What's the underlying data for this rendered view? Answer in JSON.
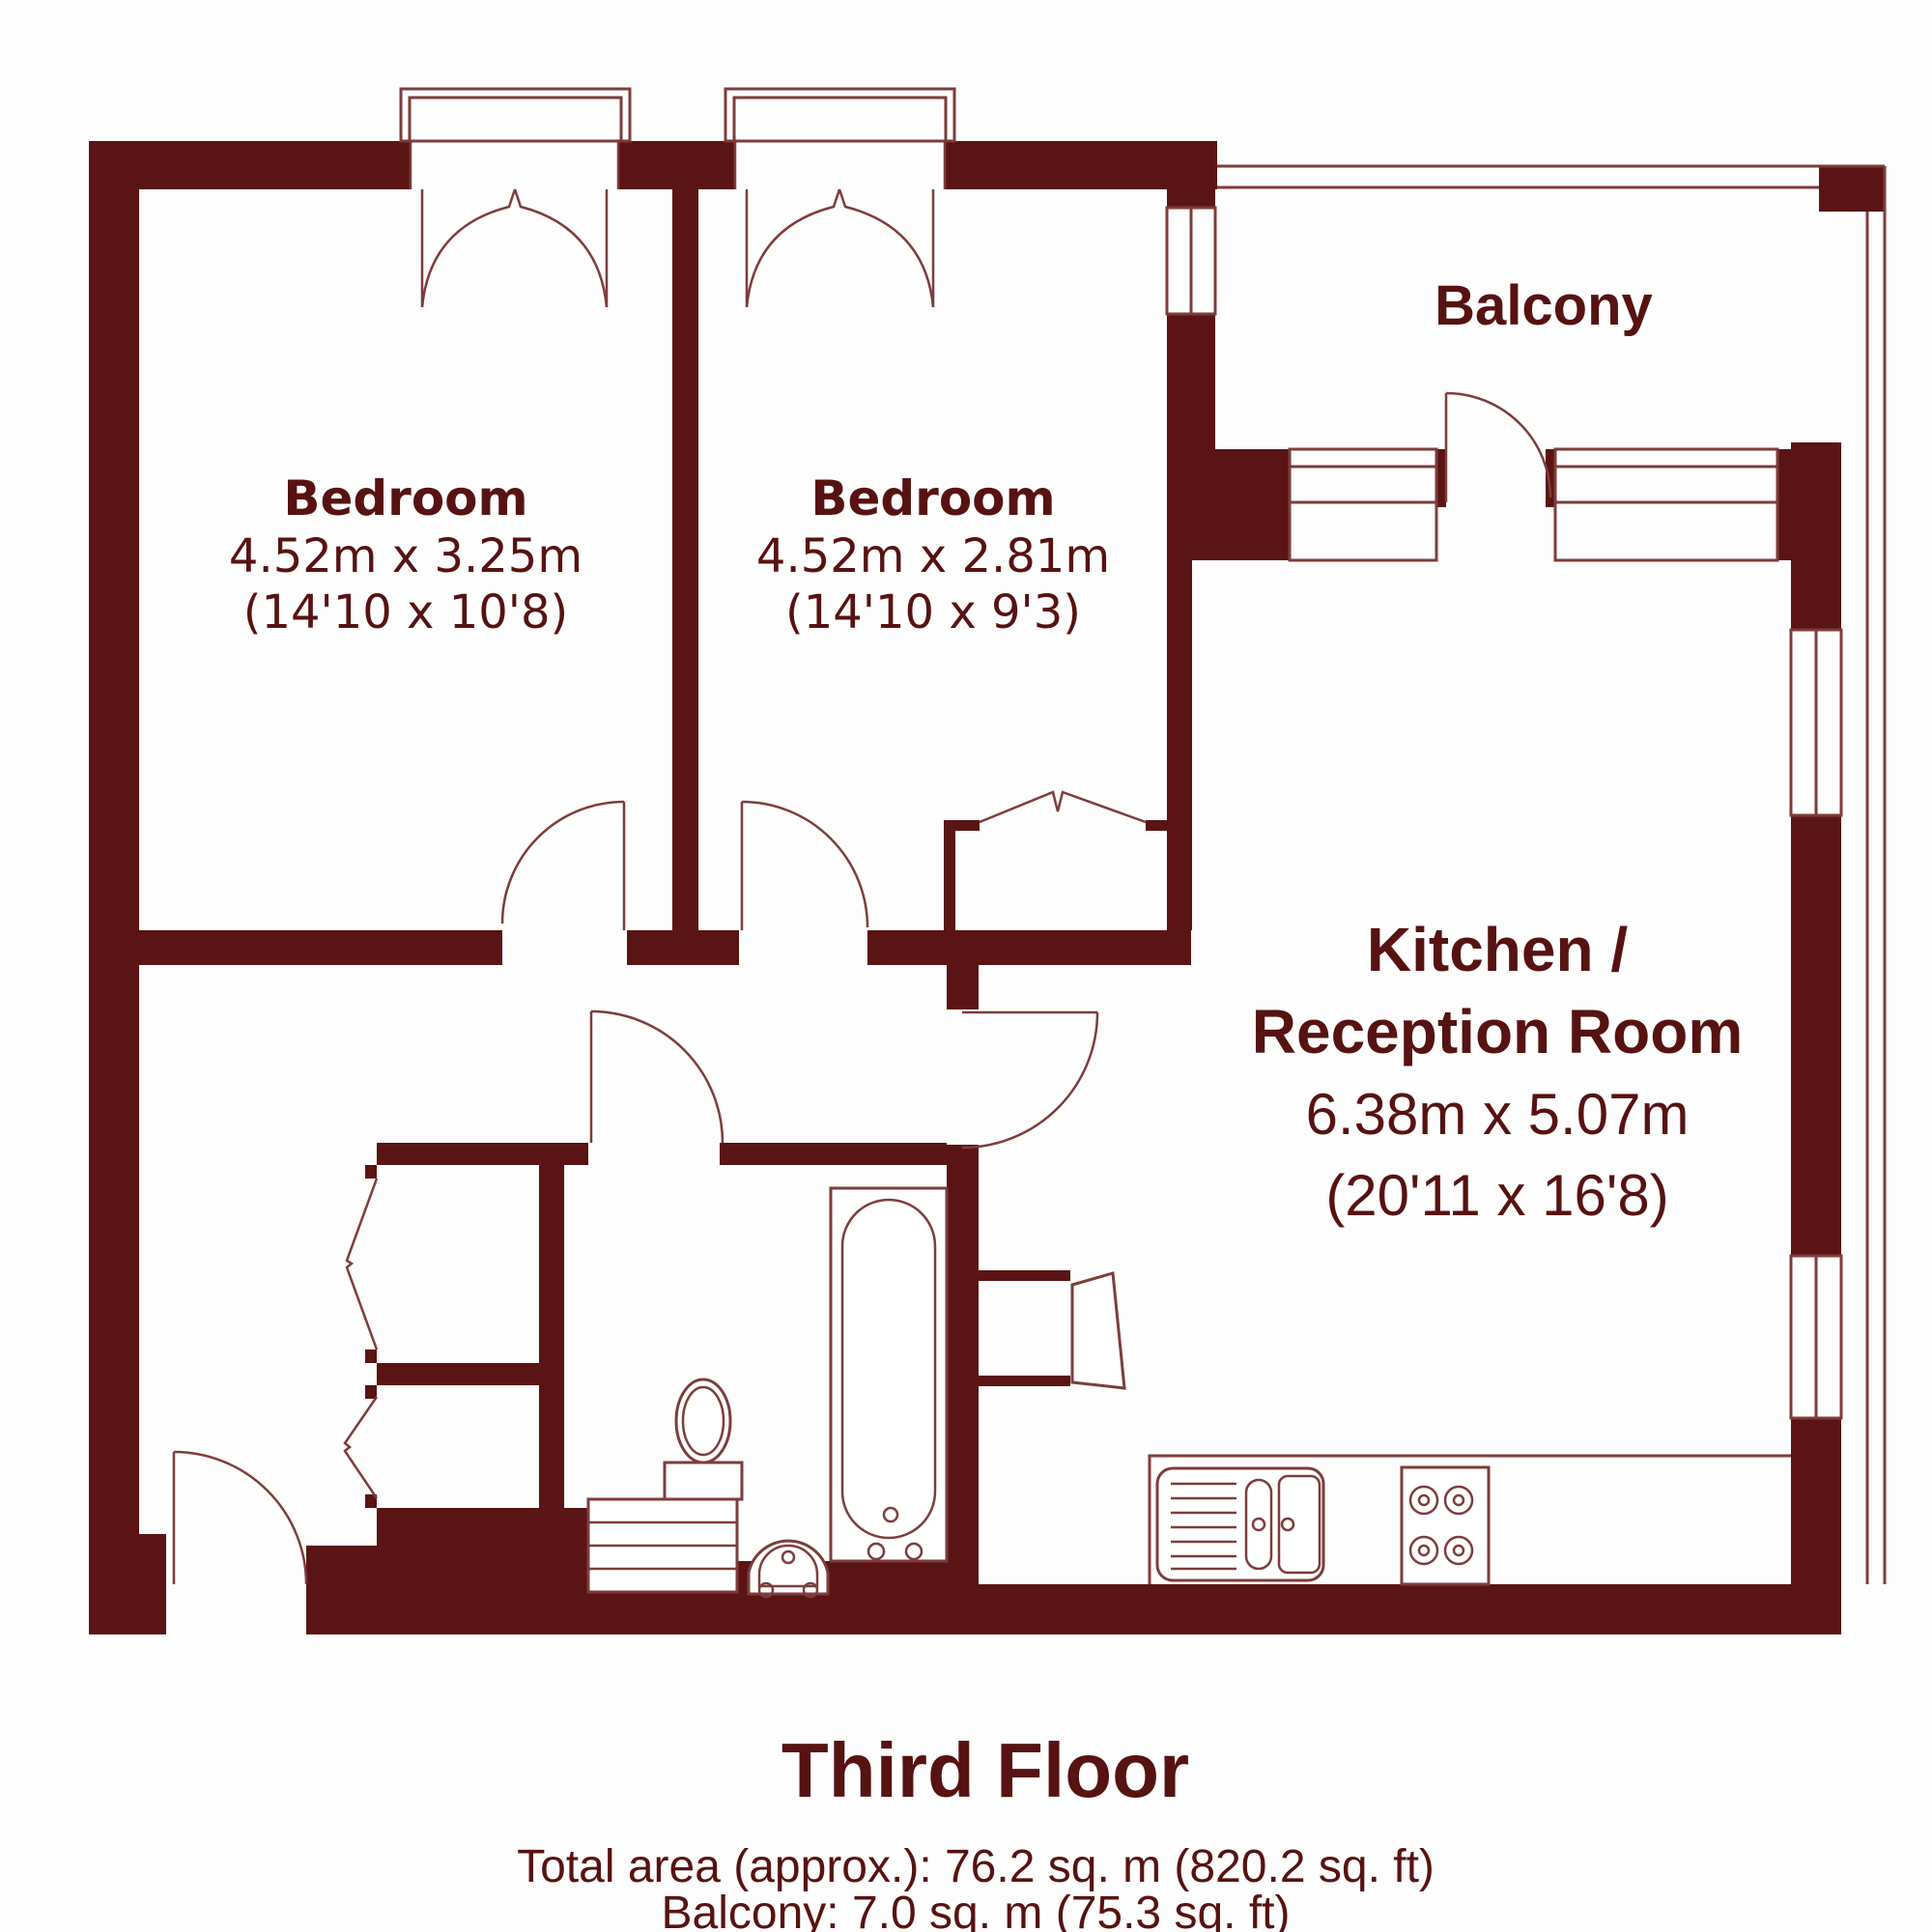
{
  "plan": {
    "rooms": [
      {
        "id": "bedroom-1",
        "name": "Bedroom",
        "metric": "4.52m x 3.25m",
        "imperial": "(14'10 x 10'8)"
      },
      {
        "id": "bedroom-2",
        "name": "Bedroom",
        "metric": "4.52m x 2.81m",
        "imperial": "(14'10 x 9'3)"
      },
      {
        "id": "kitchen-reception",
        "name_line1": "Kitchen /",
        "name_line2": "Reception Room",
        "metric": "6.38m x 5.07m",
        "imperial": "(20'11 x 16'8)"
      },
      {
        "id": "balcony",
        "name": "Balcony"
      }
    ],
    "footer": {
      "floor_title": "Third Floor",
      "total_area": "Total area (approx.): 76.2 sq. m (820.2 sq. ft)",
      "balcony_area": "Balcony: 7.0 sq. m (75.3 sq. ft)"
    },
    "colors": {
      "wall": "#5a1414",
      "line": "#7d3c3c",
      "text": "#571212",
      "background": "#fdfdfd"
    }
  }
}
